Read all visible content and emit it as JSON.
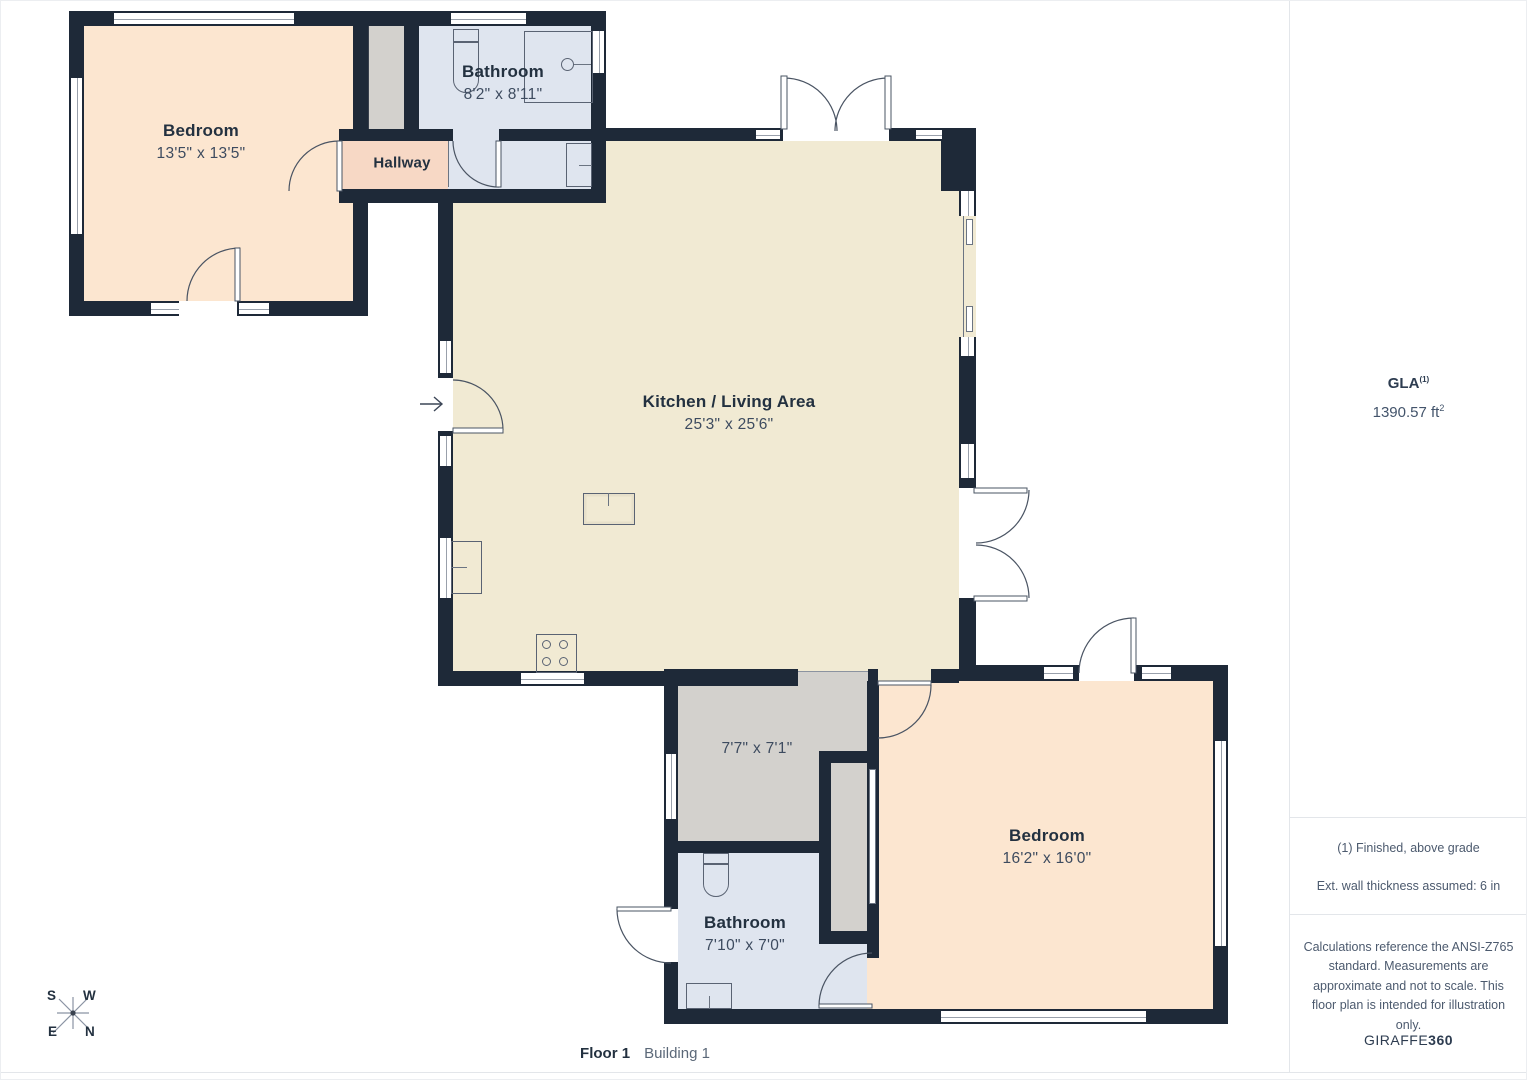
{
  "plan": {
    "floor_label": "Floor 1",
    "building_label": "Building 1",
    "rooms": {
      "bedroom_top": {
        "name": "Bedroom",
        "dims": "13'5\" x 13'5\""
      },
      "bathroom_top": {
        "name": "Bathroom",
        "dims": "8'2\" x 8'11\""
      },
      "hallway": {
        "name": "Hallway"
      },
      "kitchen": {
        "name": "Kitchen / Living Area",
        "dims": "25'3\" x 25'6\""
      },
      "utility": {
        "dims": "7'7\" x 7'1\""
      },
      "bathroom_bottom": {
        "name": "Bathroom",
        "dims": "7'10\" x 7'0\""
      },
      "bedroom_bottom": {
        "name": "Bedroom",
        "dims": "16'2\" x 16'0\""
      }
    },
    "compass": {
      "n": "N",
      "s": "S",
      "e": "E",
      "w": "W"
    }
  },
  "sidebar": {
    "gla_label": "GLA",
    "gla_sup": "(1)",
    "gla_value": "1390.57 ft",
    "gla_value_sup": "2",
    "note1": "(1) Finished, above grade",
    "note2": "Ext. wall thickness assumed: 6 in",
    "disclaimer": "Calculations reference the ANSI-Z765 standard. Measurements are approximate and not to scale. This floor plan is intended for illustration only.",
    "brand_regular": "GIRAFFE",
    "brand_bold": "360"
  },
  "colors": {
    "wall": "#1e2938",
    "bedroom_fill": "#fce6d0",
    "kitchen_fill": "#f1ead3",
    "bathroom_fill": "#dfe5ef",
    "closet_fill": "#d3d1cd",
    "hallway_fill": "#f7d8c5",
    "label_dark": "#233140",
    "dim_text": "#3d4b5f",
    "sidebar_text": "#4c5a6e",
    "divider": "#e3e6ea"
  }
}
